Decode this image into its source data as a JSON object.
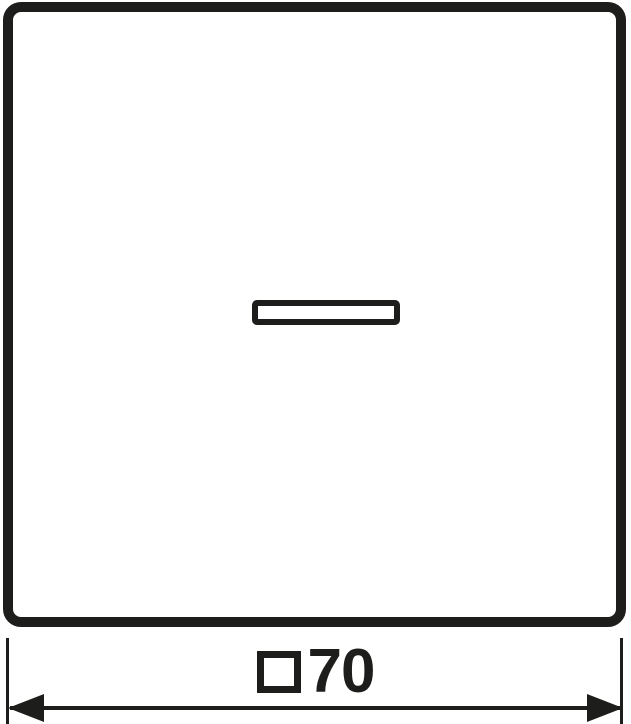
{
  "drawing": {
    "dimension": {
      "symbol": "□",
      "value": "70",
      "label": "□70"
    }
  },
  "colors": {
    "line": "#1d1d1b",
    "background": "#ffffff"
  }
}
